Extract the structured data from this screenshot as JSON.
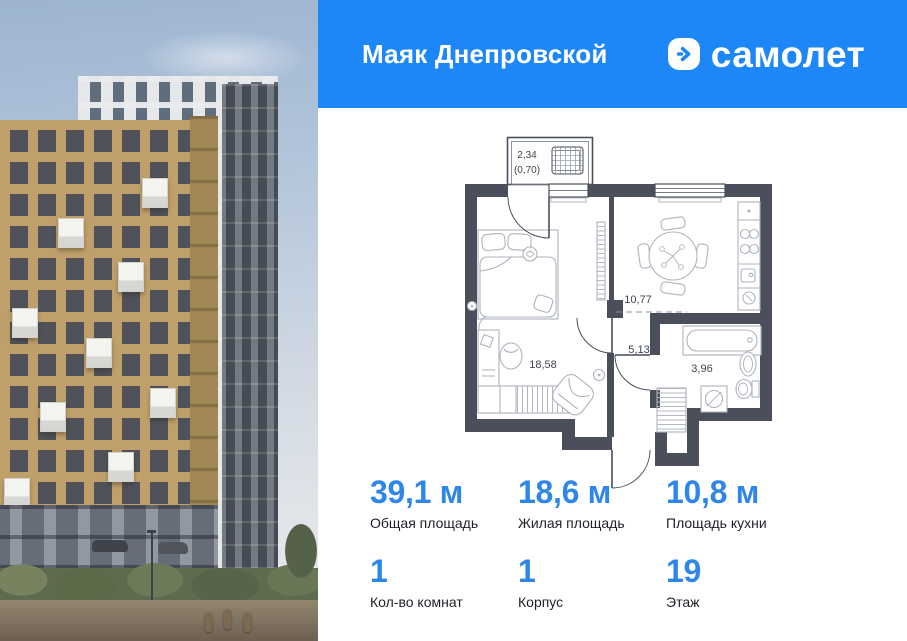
{
  "header": {
    "title": "Маяк Днепровской",
    "brand": "самолет",
    "logo_icon": "chevron-right-icon"
  },
  "colors": {
    "header_bg": "#1e87f8",
    "stat_accent": "#2e87e8",
    "plan_wall": "#4a4f5b"
  },
  "floorplan": {
    "balcony_area": "2,34",
    "balcony_area_reduced": "(0,70)",
    "bedroom_area": "18,58",
    "kitchen_area": "10,77",
    "hallway_area": "5,13",
    "bathroom_area": "3,96"
  },
  "stats": [
    {
      "value": "39,1 м",
      "label": "Общая площадь"
    },
    {
      "value": "18,6 м",
      "label": "Жилая площадь"
    },
    {
      "value": "10,8 м",
      "label": "Площадь кухни"
    },
    {
      "value": "1",
      "label": "Кол-во комнат"
    },
    {
      "value": "1",
      "label": "Корпус"
    },
    {
      "value": "19",
      "label": "Этаж"
    }
  ]
}
